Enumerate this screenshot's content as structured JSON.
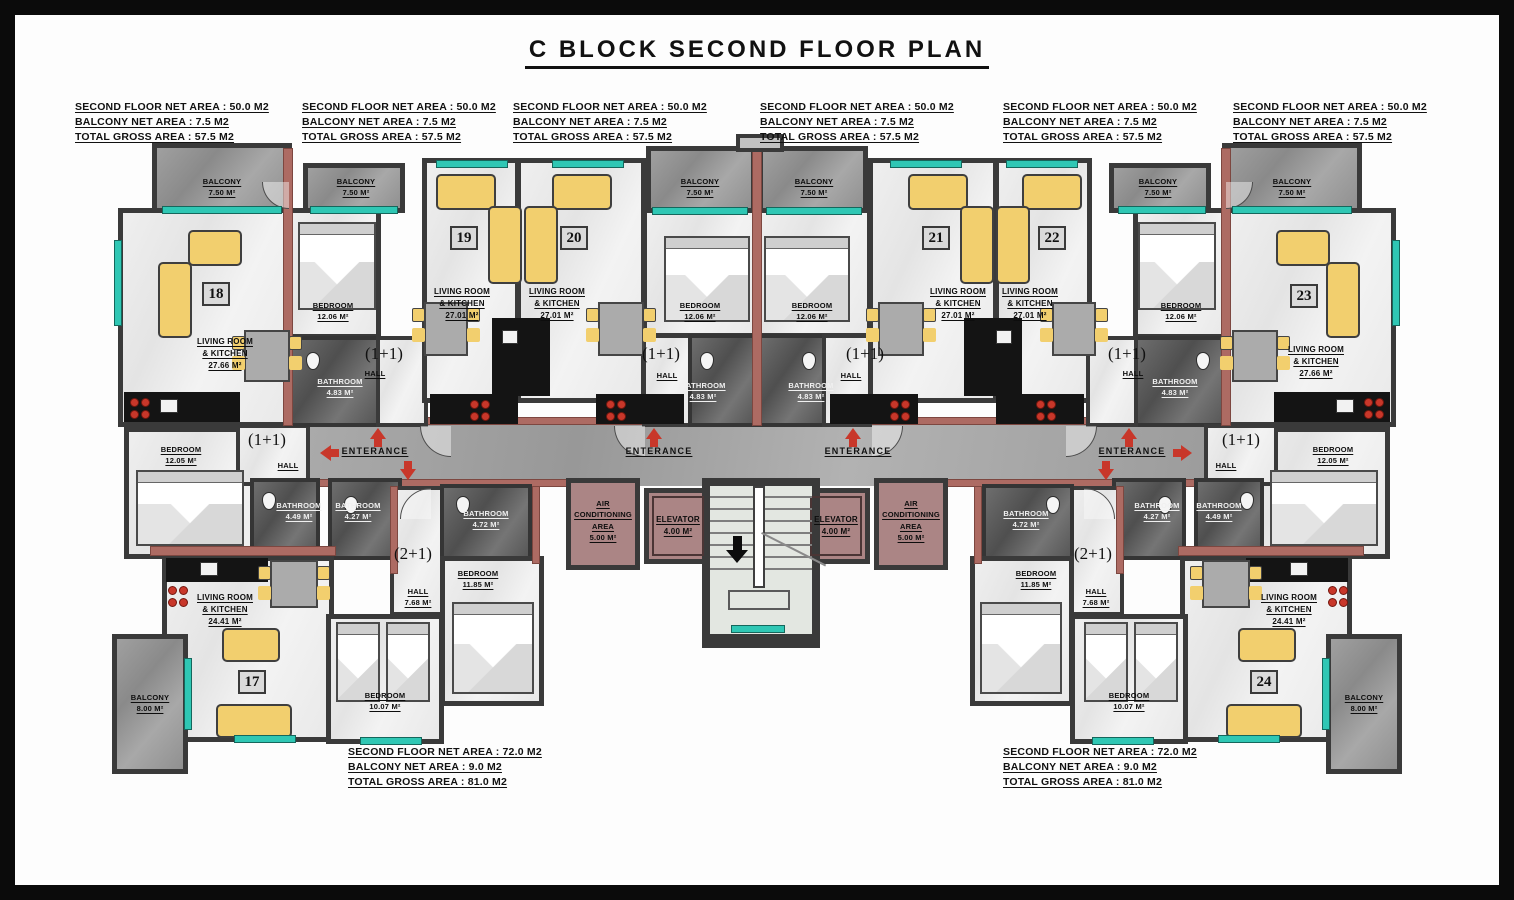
{
  "title": "C BLOCK SECOND FLOOR PLAN",
  "summary_small": {
    "net": "SECOND FLOOR NET AREA : 50.0 M2",
    "balcony": "BALCONY NET AREA : 7.5 M2",
    "gross": "TOTAL GROSS AREA : 57.5 M2"
  },
  "summary_large": {
    "net": "SECOND FLOOR NET AREA : 72.0 M2",
    "balcony": "BALCONY NET AREA : 9.0 M2",
    "gross": "TOTAL GROSS AREA : 81.0 M2"
  },
  "units": {
    "u17": "17",
    "u18": "18",
    "u19": "19",
    "u20": "20",
    "u21": "21",
    "u22": "22",
    "u23": "23",
    "u24": "24"
  },
  "rooms": {
    "balcony_750": {
      "name": "BALCONY",
      "area": "7.50 M²"
    },
    "balcony_800": {
      "name": "BALCONY",
      "area": "8.00 M²"
    },
    "bedroom_1206": {
      "name": "BEDROOM",
      "area": "12.06 M²"
    },
    "bedroom_1205": {
      "name": "BEDROOM",
      "area": "12.05 M²"
    },
    "bedroom_1185": {
      "name": "BEDROOM",
      "area": "11.85 M²"
    },
    "bedroom_1007": {
      "name": "BEDROOM",
      "area": "10.07 M²"
    },
    "living_2766": {
      "name": "LIVING ROOM",
      "name2": "& KITCHEN",
      "area": "27.66 M²"
    },
    "living_2701": {
      "name": "LIVING ROOM",
      "name2": "& KITCHEN",
      "area": "27.01 M²"
    },
    "living_2441": {
      "name": "LIVING ROOM",
      "name2": "& KITCHEN",
      "area": "24.41 M²"
    },
    "bathroom_483": {
      "name": "BATHROOM",
      "area": "4.83 M²"
    },
    "bathroom_449": {
      "name": "BATHROOM",
      "area": "4.49 M²"
    },
    "bathroom_427": {
      "name": "BATHROOM",
      "area": "4.27 M²"
    },
    "bathroom_472": {
      "name": "BATHROOM",
      "area": "4.72 M²"
    },
    "hall": {
      "name": "HALL"
    },
    "hall_768": {
      "name": "HALL",
      "area": "7.68 M²"
    },
    "elevator": {
      "name": "ELEVATOR",
      "area": "4.00 M²"
    },
    "ac_area": {
      "name": "AIR",
      "name2": "CONDITIONING",
      "name3": "AREA",
      "area": "5.00 M²"
    }
  },
  "labels": {
    "entrance": "ENTERANCE",
    "type_1plus1": "(1+1)",
    "type_2plus1": "(2+1)"
  },
  "colors": {
    "wall": "#3a3a3a",
    "accent_wall": "#ad6b63",
    "service_room": "#ab8585",
    "window": "#2fc7b4",
    "furniture": "#f2cf6e",
    "arrow": "#c8372a"
  }
}
